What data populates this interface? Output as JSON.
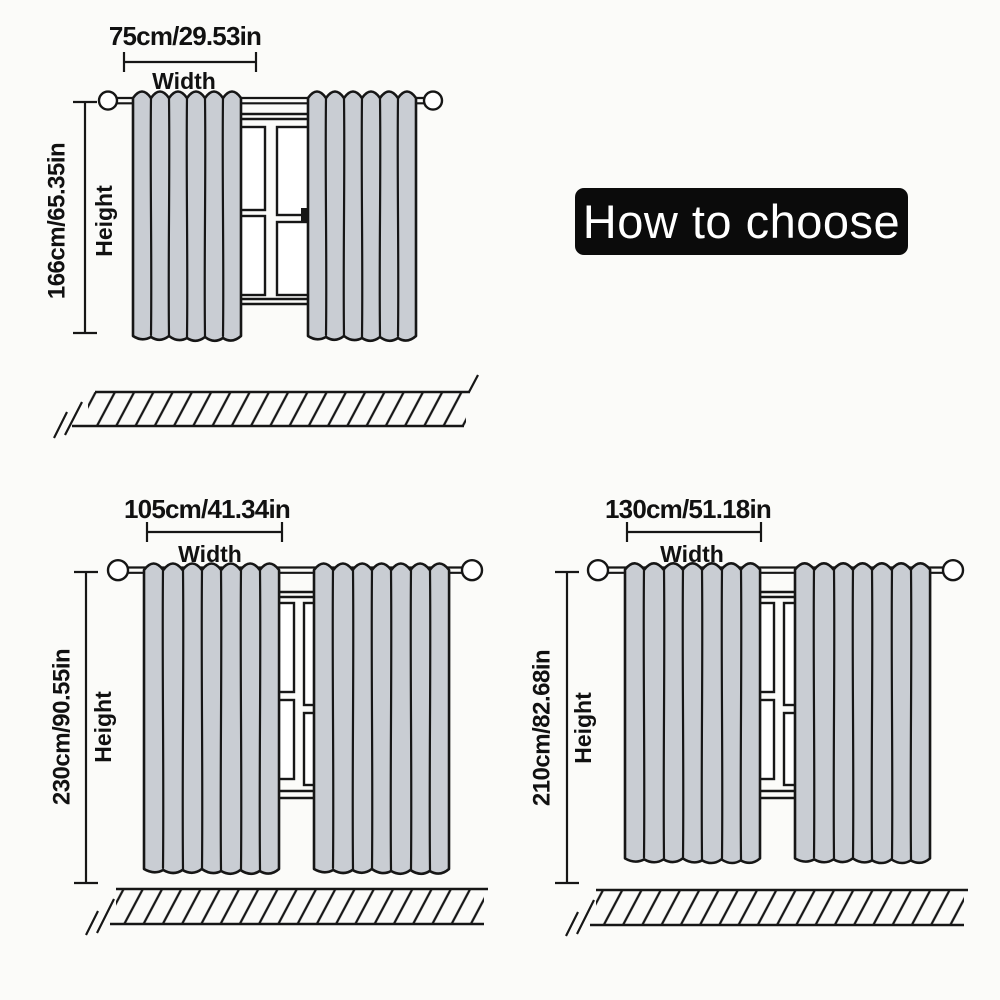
{
  "banner": {
    "label": "How to choose"
  },
  "diagrams": {
    "top": {
      "width_size": "75cm/29.53in",
      "width_label": "Width",
      "height_size": "166cm/65.35in",
      "height_label": "Height"
    },
    "bottom_left": {
      "width_size": "105cm/41.34in",
      "width_label": "Width",
      "height_size": "230cm/90.55in",
      "height_label": "Height"
    },
    "bottom_right": {
      "width_size": "130cm/51.18in",
      "width_label": "Width",
      "height_size": "210cm/82.68in",
      "height_label": "Height"
    }
  },
  "colors": {
    "curtain_fill": "#c9cdd3",
    "line": "#161616",
    "banner_bg": "#0b0b0b",
    "banner_text": "#ffffff",
    "background": "#fbfbf9"
  }
}
